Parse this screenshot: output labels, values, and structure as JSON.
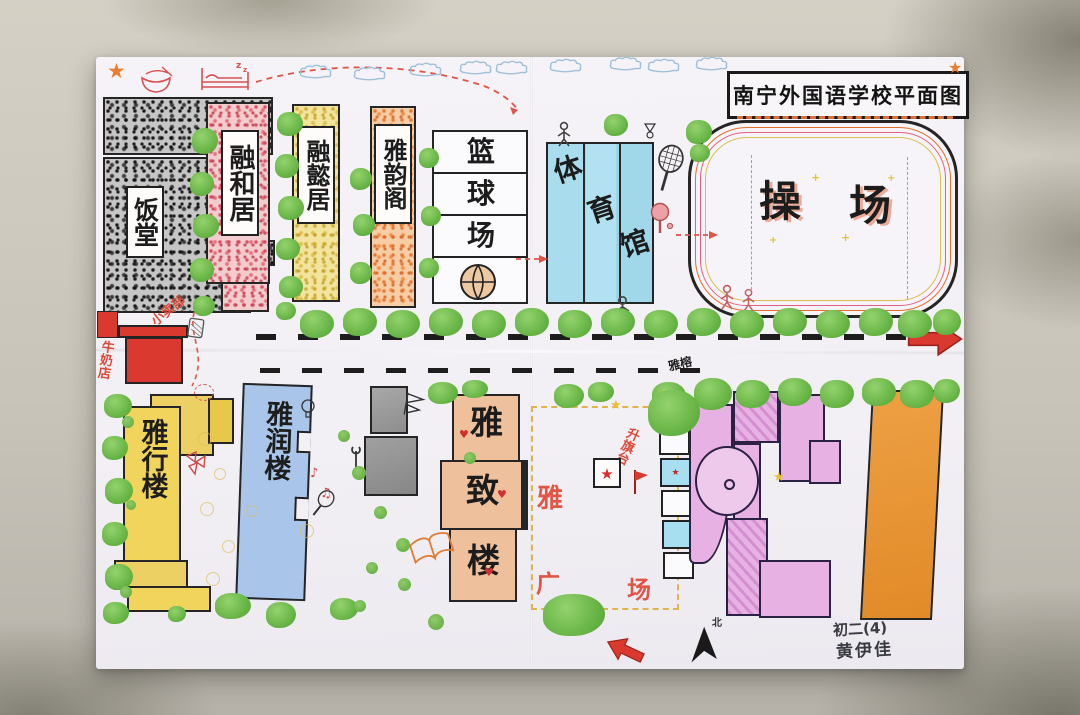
{
  "title": "南宁外国语学校平面图",
  "buildings_upper": {
    "dining_hall": "饭堂",
    "ronghe_ju": "融和居",
    "rongyi_ju": "融懿居",
    "yayun_ge": "雅韵阁",
    "basketball_court": [
      "篮",
      "球",
      "场"
    ],
    "gymnasium": [
      "体",
      "育",
      "馆"
    ],
    "playground": [
      "操",
      "场"
    ]
  },
  "road": {
    "milk_shop": "牛奶店",
    "kiosk": "小卖部",
    "banyan_tree": "雅榕"
  },
  "buildings_lower": {
    "yaxing_lou": "雅行楼",
    "yarun_lou": "雅润楼",
    "yazhi_lou": [
      "雅",
      "致",
      "楼"
    ],
    "ya_plaza": [
      "雅",
      "广",
      "场"
    ],
    "flag_platform": "升旗台"
  },
  "compass": {
    "north": "北"
  },
  "signature": {
    "class": "初二(4)",
    "name": "黄伊佳"
  },
  "colors": {
    "tree_green": "#68b546",
    "accent_red": "#d9392e",
    "gym_blue": "#a5dced",
    "yarun_blue": "#a9c6ea",
    "yaxing_yellow": "#f0d45c",
    "yazhi_peach": "#eec09c",
    "complex_pink": "#e7b2e3",
    "orange_building": "#e8912f",
    "label_red": "#d94a3a"
  }
}
